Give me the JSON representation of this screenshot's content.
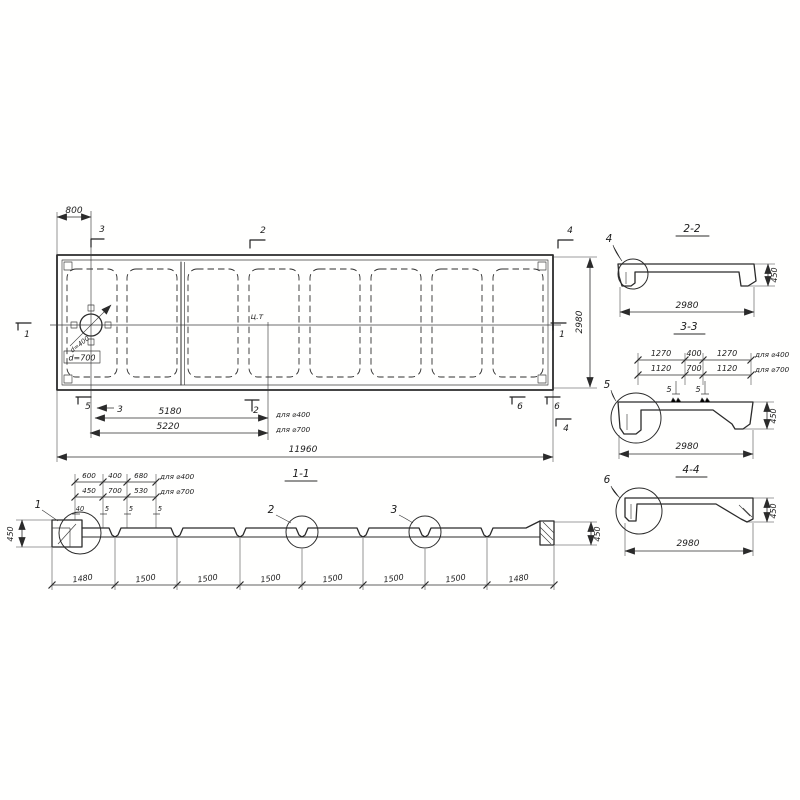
{
  "plan": {
    "dim_top": "800",
    "dim_right": "2980",
    "dim_a": "5180",
    "dim_a_note": "для ⌀400",
    "dim_b": "5220",
    "dim_b_note": "для ⌀700",
    "dim_total": "11960",
    "center_of_gravity": "ц.т",
    "hole_d1": "d=400",
    "hole_d2": "d=700",
    "marks": {
      "m1_left": "1",
      "m1_right": "1",
      "m2_top": "2",
      "m2_bottom": "2",
      "m3_top": "3",
      "m3_bottom": "3",
      "m4_top": "4",
      "m4_bottom": "4",
      "m5_bottom": "5",
      "m6_bottom_a": "6",
      "m6_bottom_b": "6"
    }
  },
  "section_1_1": {
    "title": "1-1",
    "row1": [
      "600",
      "400",
      "680"
    ],
    "row1_note": "для ⌀400",
    "row2": [
      "450",
      "700",
      "530"
    ],
    "row2_note": "для ⌀700",
    "row3": [
      "40",
      "5",
      "5",
      "5"
    ],
    "height_left": "450",
    "height_right": "450",
    "bottom_dims": [
      "1480",
      "1500",
      "1500",
      "1500",
      "1500",
      "1500",
      "1500",
      "1480"
    ],
    "details": [
      "1",
      "2",
      "3"
    ]
  },
  "section_2_2": {
    "title": "2-2",
    "detail": "4",
    "height": "450",
    "width": "2980"
  },
  "section_3_3": {
    "title": "3-3",
    "detail": "5",
    "height": "450",
    "width": "2980",
    "row1": [
      "1270",
      "400",
      "1270"
    ],
    "row1_note": "для ⌀400",
    "row2": [
      "1120",
      "700",
      "1120"
    ],
    "row2_note": "для ⌀700",
    "row3": [
      "5",
      "5"
    ]
  },
  "section_4_4": {
    "title": "4-4",
    "detail": "6",
    "height": "450",
    "width": "2980"
  }
}
